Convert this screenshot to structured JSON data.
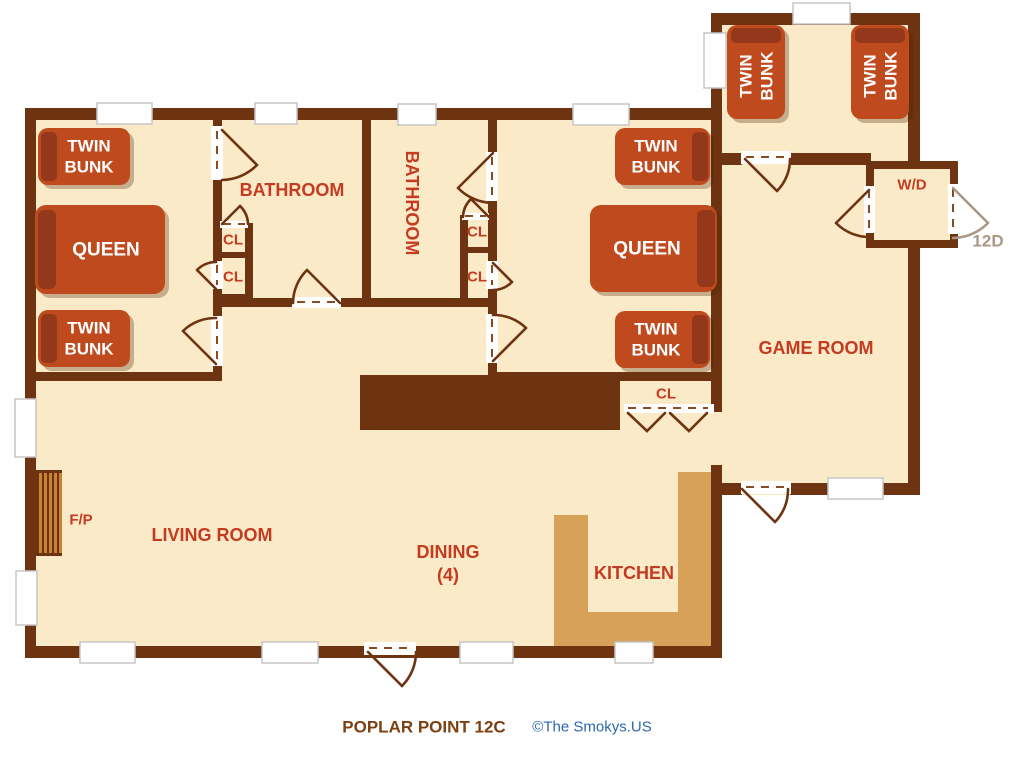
{
  "colors": {
    "wall": "#6e3310",
    "floor": "#faeac7",
    "bed": "#bf4a1e",
    "bed_shadow": "#93381a",
    "counter": "#d8a158",
    "label_red": "#c43b21",
    "caption_brown": "#7c3f11",
    "credit_blue": "#2b67b1",
    "door_gray": "#ab9886",
    "window_border": "#c6c6c6"
  },
  "caption": {
    "title": "POPLAR POINT 12C",
    "credit": "©The Smokys.US"
  },
  "labels": {
    "bathroom": "BATHROOM",
    "living_room": "LIVING ROOM",
    "dining": "DINING",
    "dining_capacity": "(4)",
    "kitchen": "KITCHEN",
    "game_room": "GAME ROOM",
    "washer_dryer": "W/D",
    "fireplace": "F/P",
    "closet": "CL",
    "entry_door": "12D"
  },
  "beds": {
    "twin_line1": "TWIN",
    "twin_line2": "BUNK",
    "queen": "QUEEN"
  }
}
